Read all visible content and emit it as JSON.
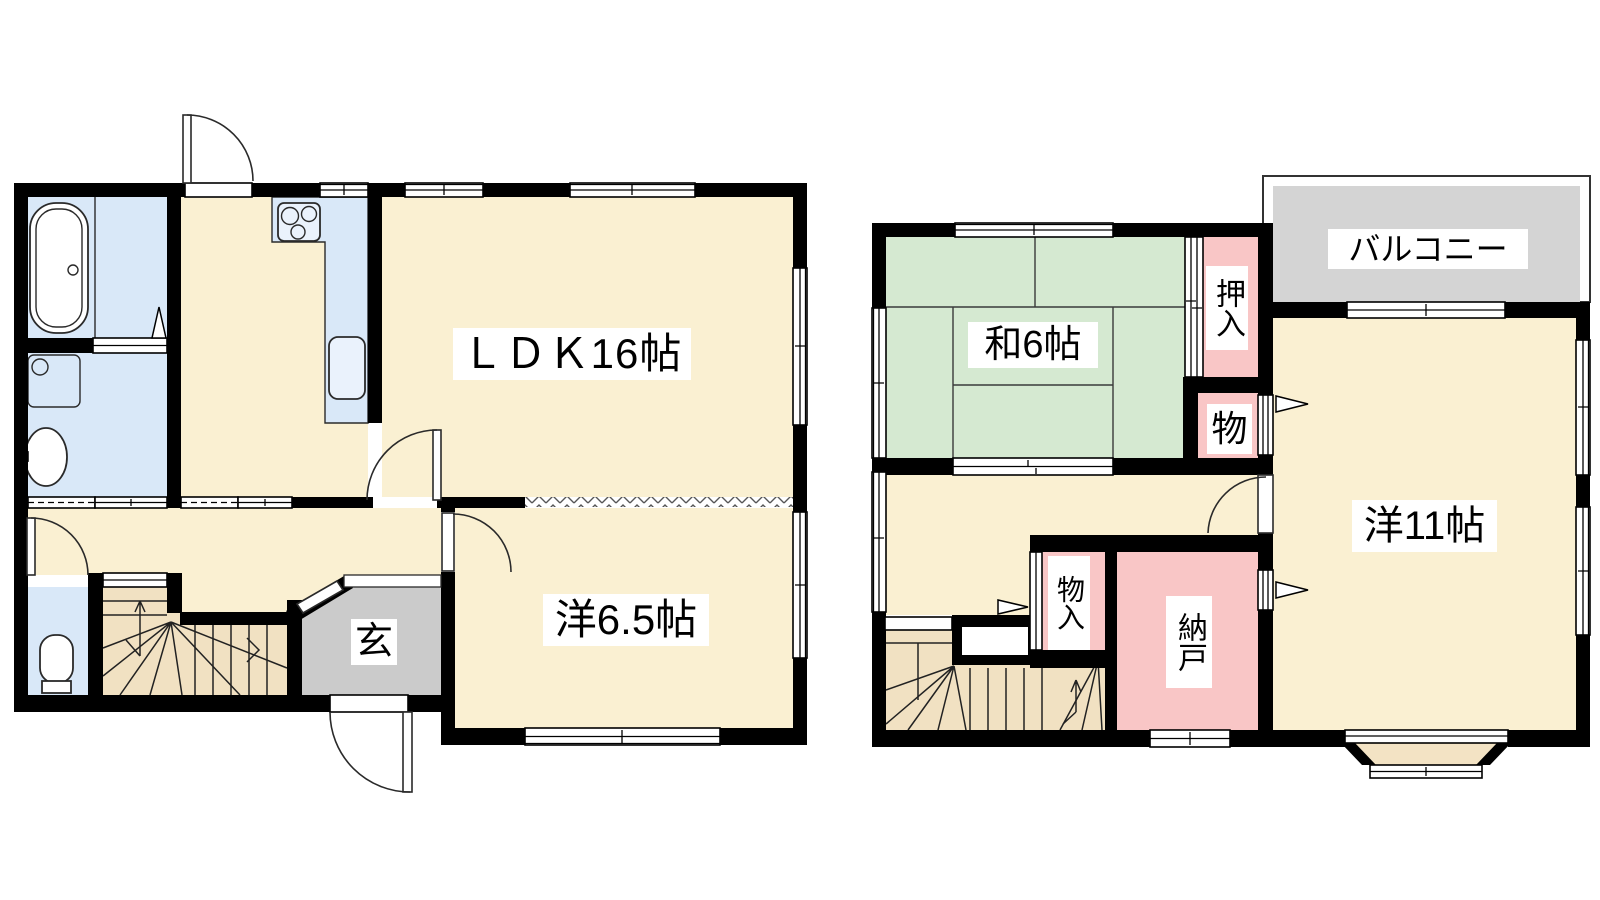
{
  "colors": {
    "wall": "#000000",
    "room_cream": "#FAF0D2",
    "wet_blue": "#D9E8F8",
    "tatami_green": "#D5E9D1",
    "storage_pink": "#F9C6C6",
    "entrance_gray": "#CBCBCB",
    "balcony_gray": "#D4D4D4",
    "stair_tan": "#F1E1C2",
    "bay_tan": "#F3E3C4",
    "label_bg": "#FFFFFF"
  },
  "first_floor": {
    "ldk_label": "ＬＤＫ16帖",
    "western_room_label": "洋6.5帖",
    "entrance_label": "玄"
  },
  "second_floor": {
    "japanese_room_label": "和6帖",
    "oshiire_label": "押入",
    "storage_small_label": "物",
    "balcony_label": "バルコニー",
    "western_room_label": "洋11帖",
    "storage_monoire_label": "物入",
    "storage_nando_label": "納戸"
  }
}
